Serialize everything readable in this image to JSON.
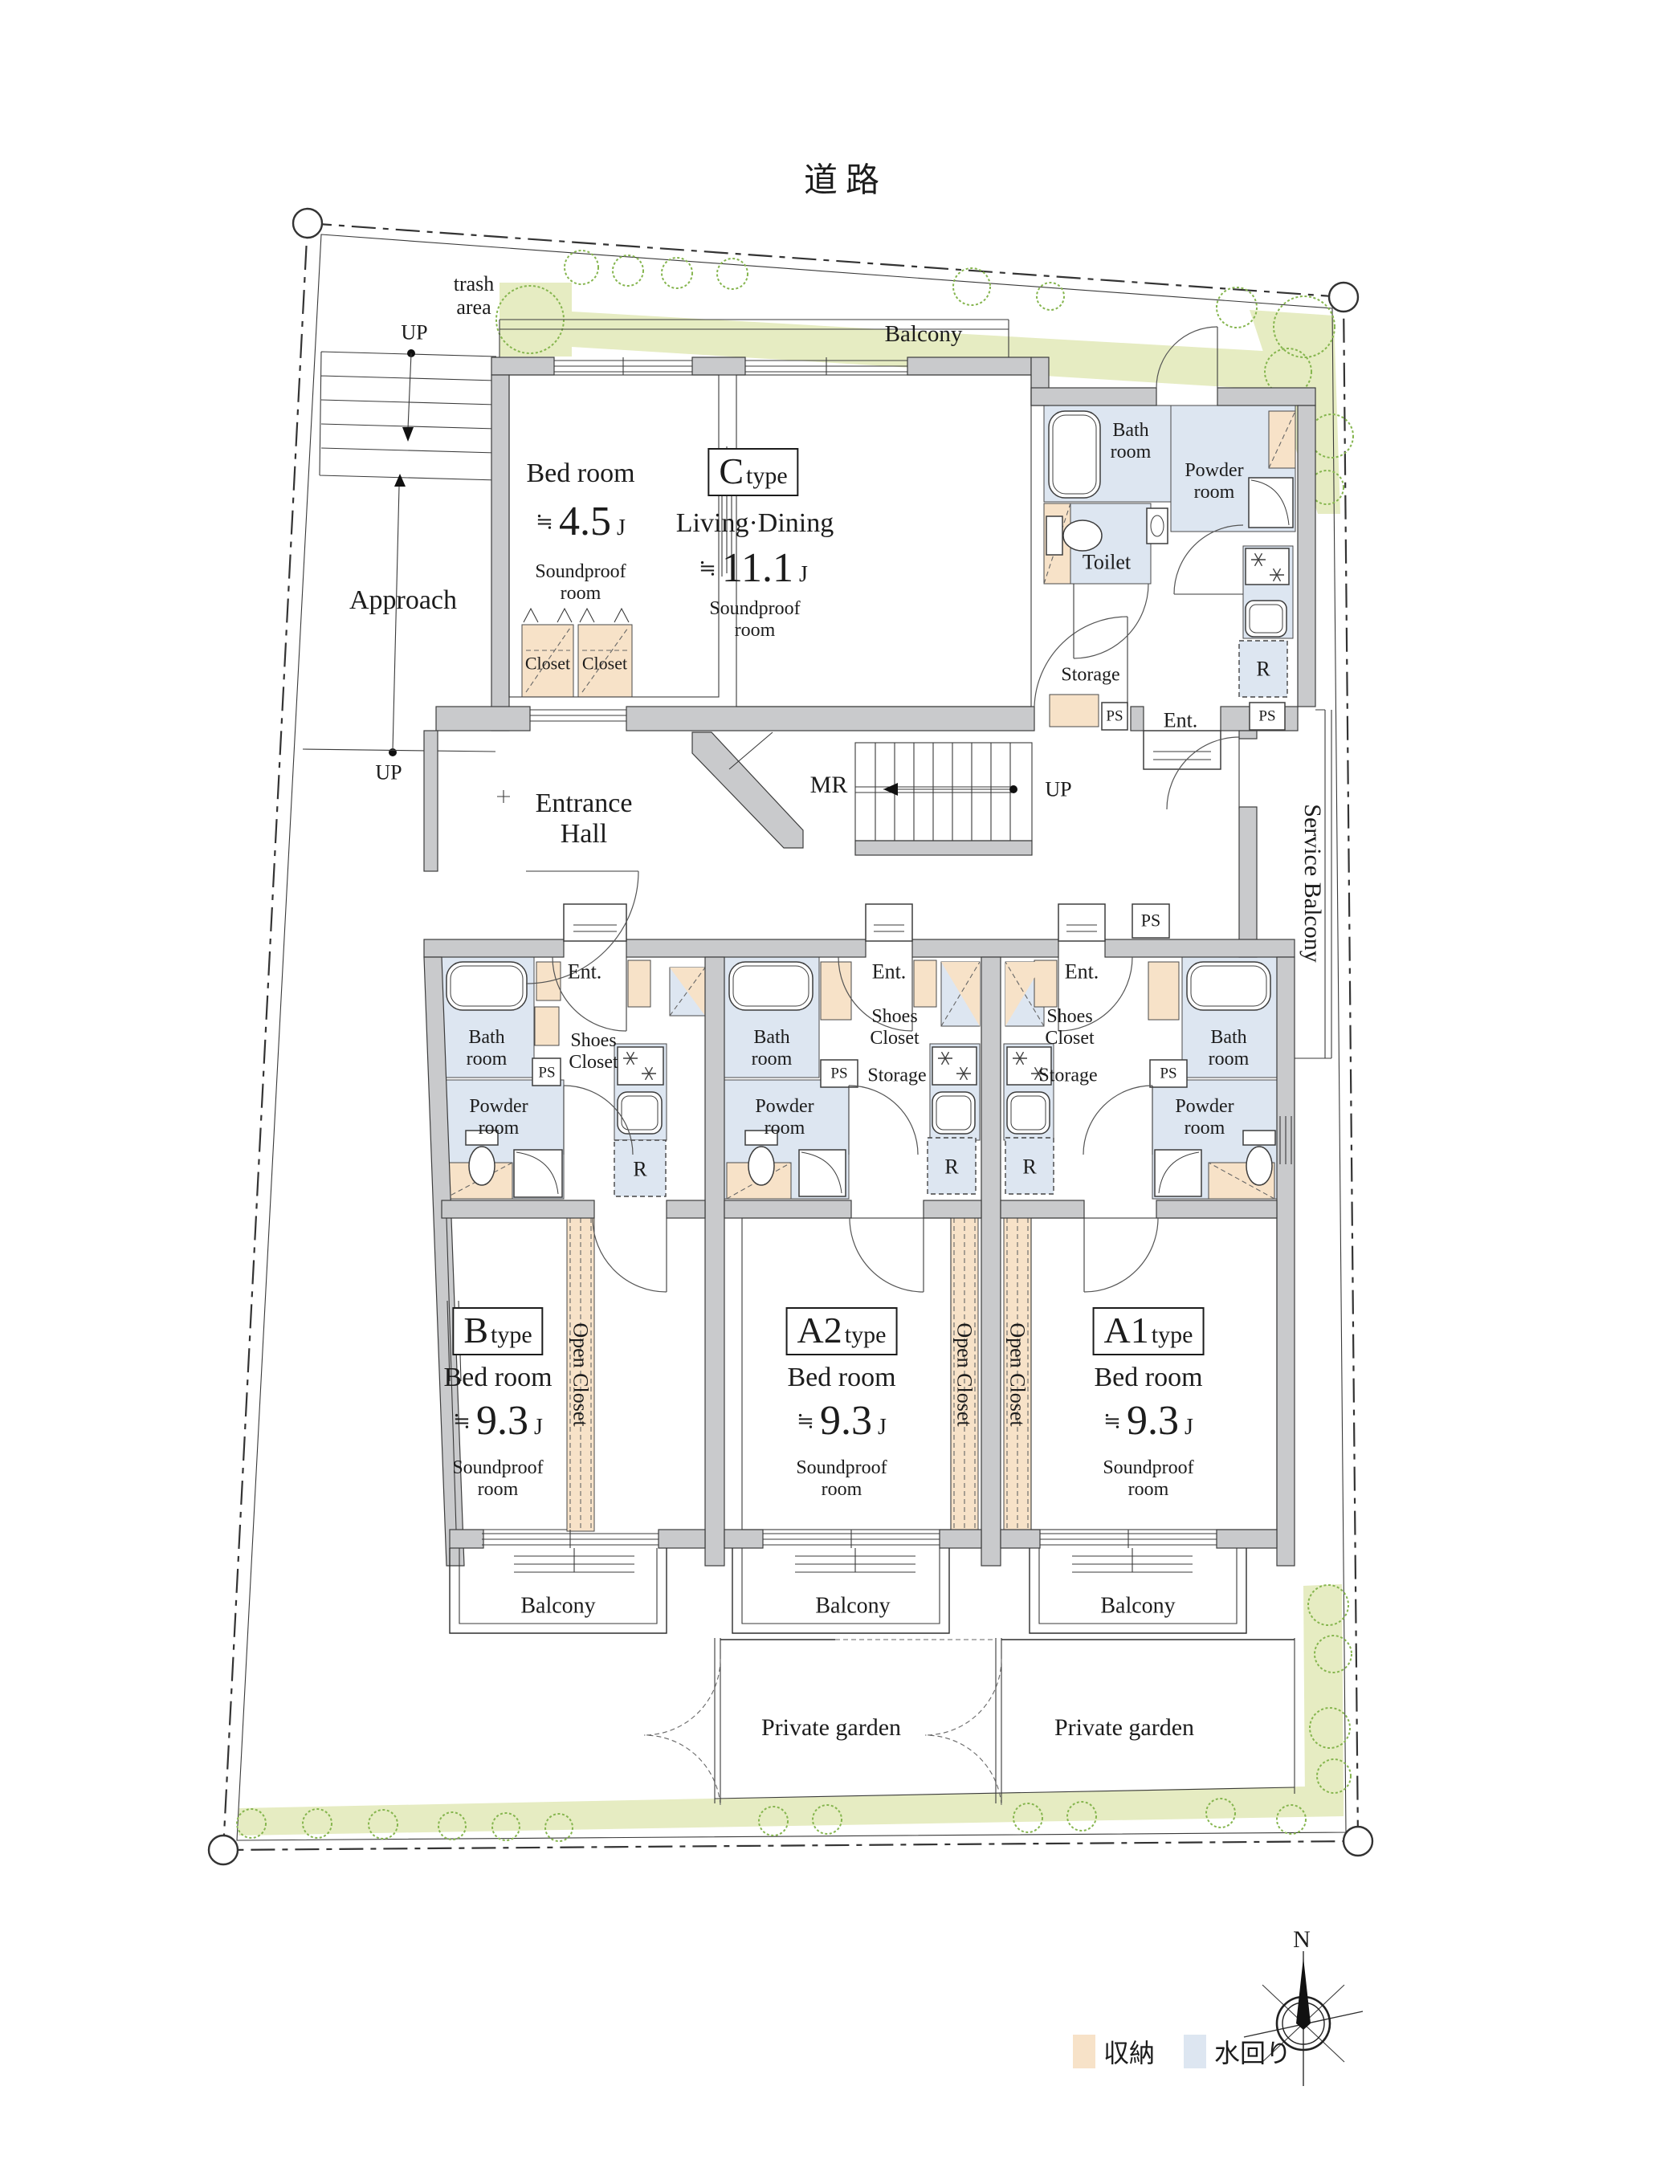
{
  "page": {
    "road_label": "道路",
    "trash_area_label": "trash area",
    "approach_label": "Approach",
    "balcony_top_label": "Balcony",
    "entrance_hall_label": "Entrance Hall",
    "mr_label": "MR",
    "up_label": "UP",
    "service_balcony_label": "Service Balcony",
    "hall_ps_label": "PS",
    "private_garden_left": "Private garden",
    "private_garden_right": "Private garden",
    "compass_north": "N"
  },
  "legend": {
    "storage_label": "収納",
    "storage_color": "#f7e2c8",
    "water_label": "水回り",
    "water_color": "#dde6f1"
  },
  "colors": {
    "wall_gray": "#c9cacc",
    "landscape_green": "#e6ecc2",
    "bush_green": "#85b54e"
  },
  "units": {
    "c": {
      "type_letter": "C",
      "type_suffix": "type",
      "living_name": "Living·Dining",
      "living_size_prefix": "≒",
      "living_size_value": "11.1",
      "living_size_unit": "J",
      "living_note": "Soundproof room",
      "bed_name": "Bed room",
      "bed_size_prefix": "≒",
      "bed_size_value": "4.5",
      "bed_size_unit": "J",
      "bed_note": "Soundproof room",
      "closet1": "Closet",
      "closet2": "Closet",
      "bath": "Bath room",
      "powder": "Powder room",
      "toilet": "Toilet",
      "storage": "Storage",
      "ent": "Ent.",
      "ps1": "PS",
      "ps2": "PS",
      "r": "R"
    },
    "b": {
      "type_letter": "B",
      "type_suffix": "type",
      "bed_name": "Bed room",
      "size_prefix": "≒",
      "size_value": "9.3",
      "size_unit": "J",
      "note": "Soundproof room",
      "open_closet": "Open Closet",
      "bath": "Bath room",
      "powder": "Powder room",
      "shoes": "Shoes Closet",
      "ent": "Ent.",
      "ps": "PS",
      "r": "R",
      "balcony": "Balcony"
    },
    "a2": {
      "type_letter": "A2",
      "type_suffix": "type",
      "bed_name": "Bed room",
      "size_prefix": "≒",
      "size_value": "9.3",
      "size_unit": "J",
      "note": "Soundproof room",
      "open_closet": "Open Closet",
      "bath": "Bath room",
      "powder": "Powder room",
      "shoes": "Shoes Closet",
      "storage": "Storage",
      "ent": "Ent.",
      "ps": "PS",
      "r": "R",
      "balcony": "Balcony"
    },
    "a1": {
      "type_letter": "A1",
      "type_suffix": "type",
      "bed_name": "Bed room",
      "size_prefix": "≒",
      "size_value": "9.3",
      "size_unit": "J",
      "note": "Soundproof room",
      "open_closet": "Open Closet",
      "bath": "Bath room",
      "powder": "Powder room",
      "shoes": "Shoes Closet",
      "storage": "Storage",
      "ent": "Ent.",
      "ps": "PS",
      "r": "R",
      "balcony": "Balcony"
    }
  }
}
